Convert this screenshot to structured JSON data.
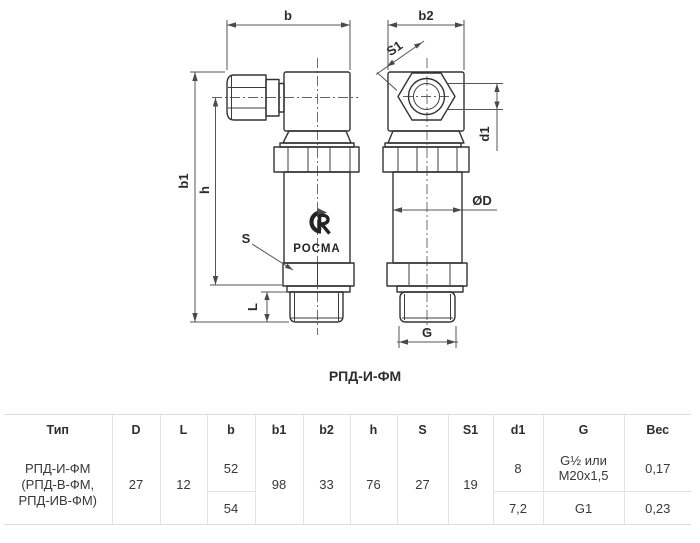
{
  "drawing": {
    "caption": "РПД-И-ФМ",
    "logo_text": "РОСМА",
    "labels": {
      "b": "b",
      "b1": "b1",
      "b2": "b2",
      "h": "h",
      "S": "S",
      "S1": "S1",
      "L": "L",
      "d1": "d1",
      "OD": "ØD",
      "G": "G"
    }
  },
  "table": {
    "headers": [
      "Тип",
      "D",
      "L",
      "b",
      "b1",
      "b2",
      "h",
      "S",
      "S1",
      "d1",
      "G",
      "Вес"
    ],
    "row": {
      "type": "РПД-И-ФМ\n(РПД-В-ФМ,\nРПД-ИВ-ФМ)",
      "D": "27",
      "L": "12",
      "b": [
        "52",
        "54"
      ],
      "b1": "98",
      "b2": "33",
      "h": "76",
      "S": "27",
      "S1": "19",
      "d1": [
        "8",
        "7,2"
      ],
      "G": [
        "G½ или M20x1,5",
        "G1"
      ],
      "ves": [
        "0,17",
        "0,23"
      ]
    }
  }
}
